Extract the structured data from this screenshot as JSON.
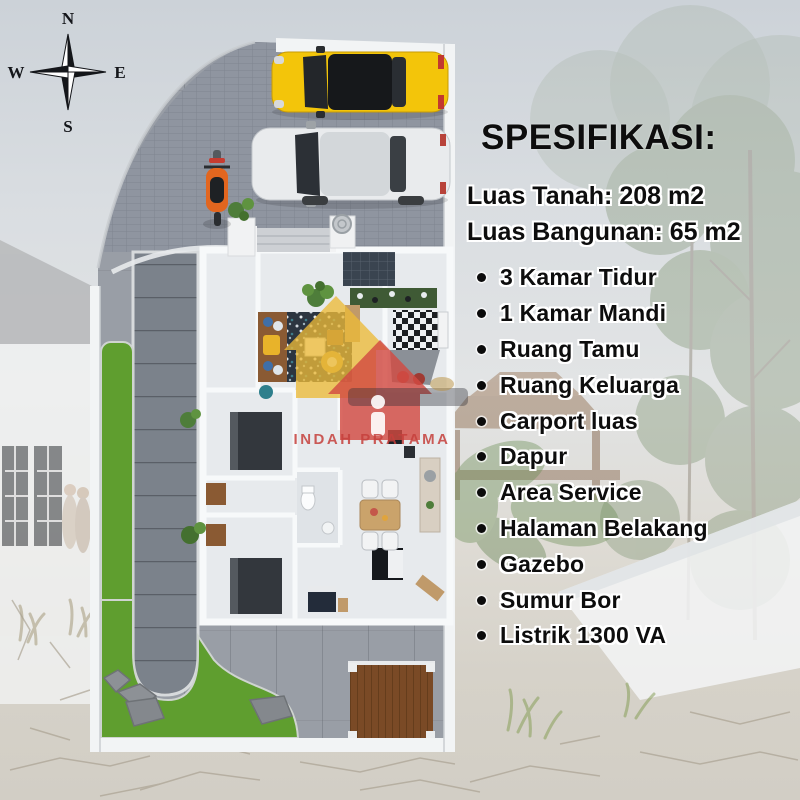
{
  "compass": {
    "north": "N",
    "east": "E",
    "south": "S",
    "west": "W"
  },
  "spec_panel": {
    "title": "SPESIFIKASI:",
    "land_area": "Luas Tanah: 208 m2",
    "building_area": "Luas Bangunan: 65 m2",
    "features": [
      "3 Kamar Tidur",
      "1 Kamar Mandi",
      "Ruang Tamu",
      "Ruang Keluarga",
      "Carport luas",
      "Dapur",
      "Area Service",
      "Halaman Belakang",
      "Gazebo",
      "Sumur Bor",
      "Listrik 1300 VA"
    ]
  },
  "watermark": {
    "brand_text": "INDAH PRATAMA"
  },
  "colors": {
    "text_black": "#0d0d0d",
    "lawn_green": "#5f9e2f",
    "carport_brick": "#8f95a0",
    "concrete_slab": "#999ea6",
    "path_slab": "#7b828b",
    "car_yellow": "#f3c50a",
    "car_silver": "#e9ebed",
    "scooter_orange": "#e2661f",
    "deck_brown": "#7a4a26",
    "logo_yellow": "#ecba38",
    "logo_red": "#d24a42",
    "logo_text_red": "#c6403c",
    "wall_white": "#f2f4f5"
  }
}
